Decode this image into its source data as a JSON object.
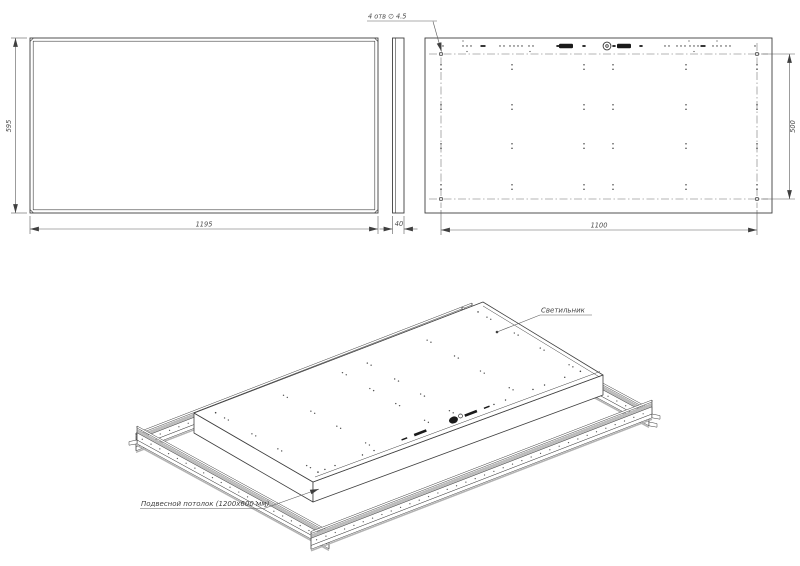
{
  "drawing_title": "Технический чертёж светодиодной панели 1195x595x40 в подвесном потолке",
  "front_view": {
    "height_dim": "595",
    "width_dim": "1195"
  },
  "side_view": {
    "depth_dim": "40"
  },
  "back_view": {
    "width_dim": "1100",
    "height_dim": "500",
    "holes_note": "4 отв  ∅ 4.5"
  },
  "iso_view": {
    "fixture_label": "Светильник",
    "ceiling_label": "Подвесной потолок (1200x600 мм)"
  },
  "colors": {
    "line": "#3f3f3f",
    "dim_line": "#5a5a5a",
    "centerline": "#6a6a6a",
    "shade_gray": "#bdbdbd",
    "shadow_gray": "#b3b3b3",
    "mark_dark": "#1a1a1a",
    "background": "#ffffff"
  }
}
